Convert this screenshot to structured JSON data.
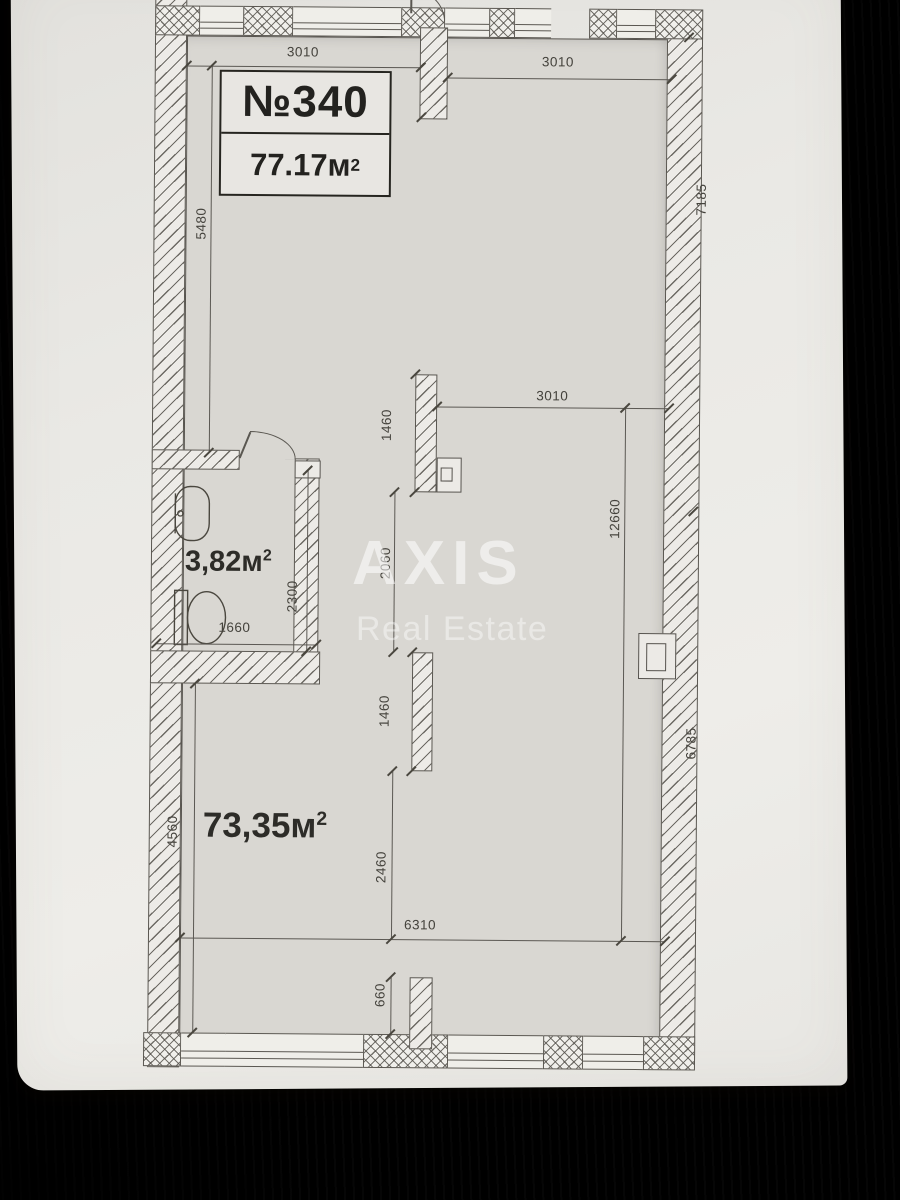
{
  "plan": {
    "unit_label": "№340",
    "unit_area": "77.17м",
    "unit_area_sup": "2",
    "rooms": {
      "main": {
        "area": "73,35м",
        "sup": "2"
      },
      "bathroom": {
        "area": "3,82м",
        "sup": "2"
      }
    },
    "dimensions": {
      "top_left": "3010",
      "top_right": "3010",
      "left_upper": "5480",
      "right_upper": "7185",
      "mid_width": "3010",
      "pilaster_upper": "1460",
      "hall_height": "12660",
      "between_pilasters": "2060",
      "pilaster_lower": "1460",
      "bathroom_width": "1660",
      "bathroom_height": "2300",
      "right_lower": "6785",
      "below_pilaster": "2460",
      "left_lower": "4560",
      "bottom_width": "6310",
      "bottom_pier": "660"
    }
  },
  "watermark": {
    "line1": "AXIS",
    "line2": "Real Estate"
  },
  "colors": {
    "paper": "#eae9e5",
    "plan_floor": "#d9d7d2",
    "line": "#56534e",
    "wood": "#573a26"
  }
}
